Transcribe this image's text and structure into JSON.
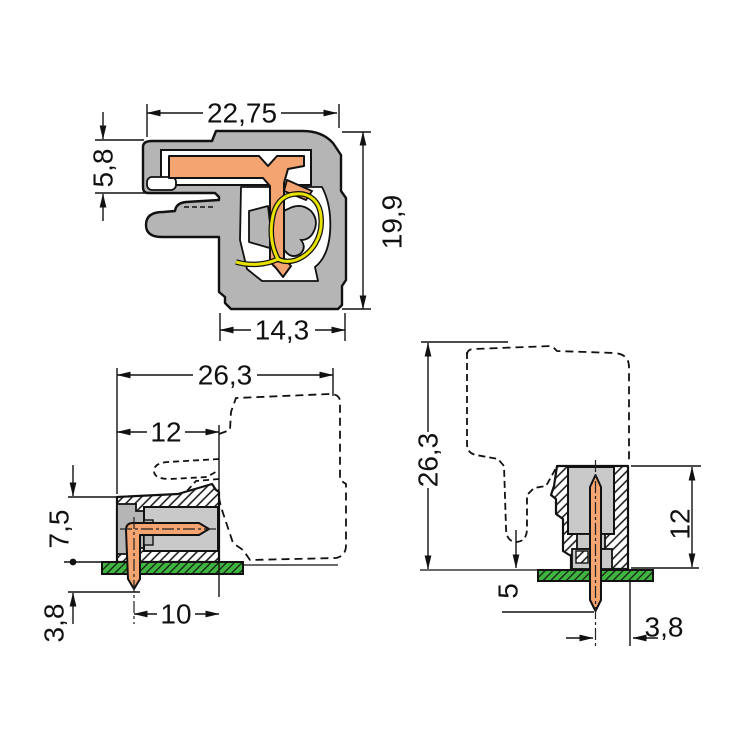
{
  "views": {
    "section": {
      "overall_width": "22,75",
      "entry_height": "5,8",
      "overall_height": "19,9",
      "base_width": "14,3"
    },
    "side": {
      "overall_depth": "26,3",
      "header_depth": "12",
      "height_above_board": "7,5",
      "pin_below_board": "3,8",
      "pin_to_face": "10"
    },
    "front": {
      "overall_height": "26,3",
      "header_height": "12",
      "pin_protrusion": "5",
      "pin_to_edge": "3,8"
    }
  },
  "colors": {
    "housing_gray": "#b5b5b5",
    "cavity_gray": "#c9c9c9",
    "contact_orange": "#f4a470",
    "spring_yellow": "#e8e200",
    "pcb_green": "#3fb43f",
    "line_black": "#111111",
    "background": "#ffffff"
  }
}
